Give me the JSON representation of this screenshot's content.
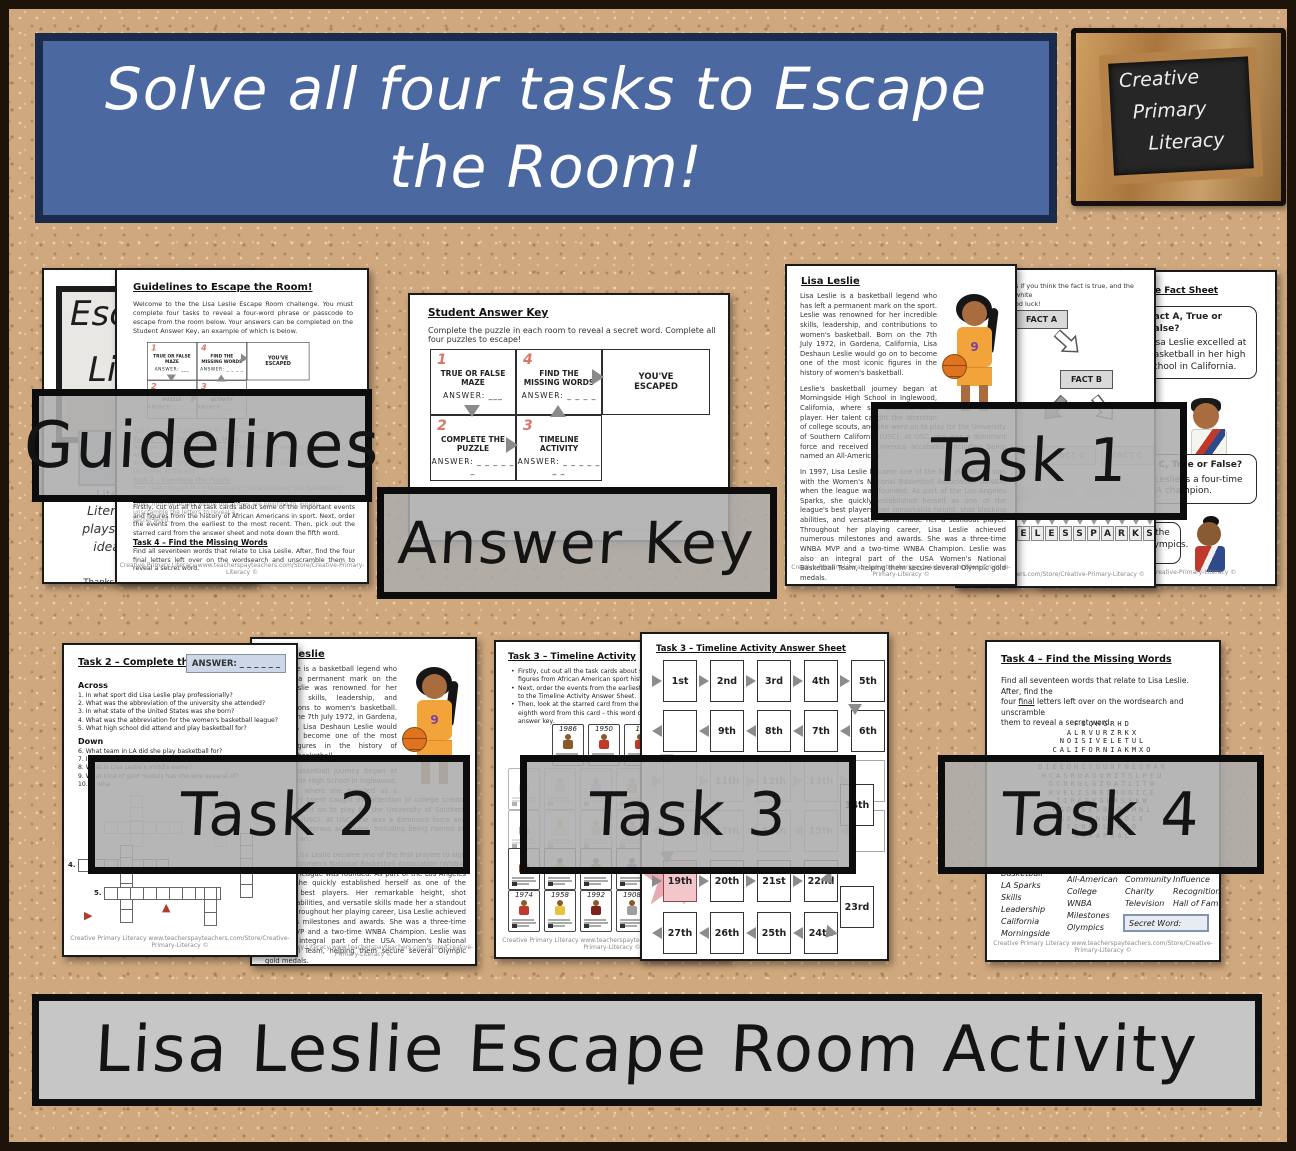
{
  "colors": {
    "cork": "#d0a87e",
    "banner_blue": "#4b69a0",
    "banner_border": "#1b2b4c",
    "label_gray": "#acacac",
    "red_number": "#d9776b",
    "star_pink": "#e9aab1",
    "jersey_orange": "#f2a33a",
    "link_blue": "#3344cc"
  },
  "banner": {
    "line1": "Solve all four tasks to Escape",
    "line2": "the Room!"
  },
  "logo": {
    "line1": "Creative",
    "line2": "Primary",
    "line3": "Literacy"
  },
  "bottom_banner": {
    "text": "Lisa Leslie Escape Room Activity"
  },
  "labels": {
    "guidelines": "Guidelines",
    "answer_key": "Answer Key",
    "task1": "Task 1",
    "task2": "Task 2",
    "task3": "Task 3",
    "task4": "Task 4"
  },
  "footer_text": "Creative Primary Literacy www.teacherspayteachers.com/Store/Creative-Primary-Literacy  ©",
  "cover": {
    "big1": "Esc",
    "big2": "Lis",
    "link1": "Literacy s",
    "hand_lines": [
      "Literacy re",
      "playscripts,",
      "ideas and",
      "ac"
    ],
    "thanks_pre": "Thanks to ",
    "thanks_link": "Prince"
  },
  "guidelines_page": {
    "title": "Guidelines to Escape the Room!",
    "intro": "Welcome to the the Lisa Leslie Escape Room challenge. You must complete four tasks to reveal a four-word phrase or passcode to escape from the room below. Your answers can be completed on the Student Answer Key, an example of which is below.",
    "faded_lines": [
      {
        "t": "Just follow the instructions for each task and",
        "c": ""
      },
      {
        "t": "Task 1 – The True or False Maze",
        "c": "fh"
      },
      {
        "t": "Work your way through the maze from the start, reading each fact and working out if it is true",
        "c": ""
      },
      {
        "t": "or false. Then follow the arrows to the next fact until you reach one of the boxes at the end",
        "c": ""
      },
      {
        "t": "Task 2 – Complete the Puzzle",
        "c": "fh"
      },
      {
        "t": "First, read through the informational text and answer the questions to complete the crossword.",
        "c": ""
      },
      {
        "t": "Then, find the letters where the arrows are pointing to. Finally, unscramble the letters to reveal a",
        "c": ""
      },
      {
        "t": "secret word.",
        "c": ""
      }
    ],
    "task3_heading": "Task 3 – Timeline Activity",
    "task3_text": "Firstly, cut out all the task cards about some of the important events and figures from the history of African Americans in sport. Next, order the events from the earliest to the most recent. Then, pick out the starred card from the answer sheet and note down the fifth word.",
    "task4_heading": "Task 4 – Find the Missing Words",
    "task4_text": "Find all seventeen words that relate to Lisa Leslie. After, find the four final letters left over on the wordsearch and unscramble them to reveal a secret word."
  },
  "answer_key": {
    "title": "Student Answer Key",
    "intro": "Complete the puzzle in each room to reveal a secret word. Complete all four puzzles to escape!",
    "c1": {
      "num": "1",
      "name": "TRUE OR FALSE MAZE",
      "answer": "ANSWER: ___"
    },
    "c4": {
      "num": "4",
      "name": "FIND THE MISSING WORDS",
      "answer": "ANSWER: _ _ _ _"
    },
    "escaped": "YOU'VE ESCAPED",
    "c2": {
      "num": "2",
      "name": "COMPLETE THE PUZZLE",
      "answer": "ANSWER: _ _ _ _ _ _"
    },
    "c3": {
      "num": "3",
      "name": "TIMELINE ACTIVITY",
      "answer": "ANSWER: _ _ _ _ _ _ _"
    }
  },
  "passage": {
    "title": "Lisa Leslie",
    "jersey_number": "9",
    "paragraphs": [
      "Lisa Leslie is a basketball legend who has left a permanent mark on the sport. Leslie was renowned for her incredible skills, leadership, and contributions to women's basketball. Born on the 7th July 1972, in Gardena, California, Lisa Deshaun Leslie would go on to become one of the most iconic figures in the history of women's basketball.",
      "Leslie's basketball journey began at Morningside High School in Inglewood, California, where she excelled as a player. Her talent caught the attention of college scouts, and she went on to play for the University of Southern California (USC). At USC, she was a dominant force and received numerous accolades, including being named an All-American.",
      "In 1997, Lisa Leslie became one of the first players to sign with the Women's National Basketball Association (WNBA) when the league was founded. As part of the Los Angeles Sparks, she quickly established herself as one of the league's best players. Her remarkable height, shot blocking abilities, and versatile skills made her a standout player. Throughout her playing career, Lisa Leslie achieved numerous milestones and awards. She was a three-time WNBA MVP and a two-time WNBA Champion. Leslie was also an integral part of the USA Women's National Basketball Team, helping them secure several Olympic gold medals.",
      "Lisa Leslie's impact on women's basketball extended beyond the court. She was a role model for aspiring young athletes and actively worked to promote the growth of women's basketball. She was involved in various community and charitable activities, using her platform to inspire others. Off the court, Lisa Leslie has worked in the media and entertainment industry. Her career included television appearances, book authorship, and involvement in charitable organizations.",
      "Her dedication to promoting women's sports and her positive influence on and off the court made her a beloved figure in the world of sports. In recognition of her extraordinary contributions to basketball, Lisa Leslie was inducted into the Naismith Memorial Basketball Hall of Fame, cementing her legacy as one of the most significant figures in the history of women's sports."
    ]
  },
  "maze": {
    "intro_line1": "s if you think the fact is true, and the white",
    "intro_line2": "od luck!",
    "fact_a": "FACT A",
    "fact_b": "FACT B",
    "fact_c": "FACT C",
    "letters": [
      "",
      "",
      "",
      "E",
      "L",
      "E",
      "S",
      "S",
      "P",
      "A",
      "R",
      "K",
      "S"
    ],
    "footer_fragment": "rspayteachers.com/Store/Creative-Primary-Literacy  ©"
  },
  "fact_sheet": {
    "heading": "e Fact Sheet",
    "bubble1_title": "Fact A, True or False?",
    "bubble1_lines": [
      "Lisa Leslie excelled at",
      "basketball in her high",
      "school in California."
    ],
    "bubble2_title": "Fact C, True or False?",
    "bubble2_lines": [
      "Lisa Leslie is a four-time",
      "WNBA champion."
    ],
    "bubble3_lines": [
      "in the",
      "Olympics."
    ],
    "footer_fragment": "achers.com/Store/Creative-Primary-Literacy  ©"
  },
  "task2": {
    "title": "Task 2 – Complete the Puzzle",
    "answer_box": "ANSWER: _ _ _ _ _ _",
    "across_heading": "Across",
    "across": [
      "1.  In what sport did Lisa Leslie play professionally?",
      "2.  What was the abbreviation of the university she attended?",
      "3.  In what state of the United States was she born?",
      "4.  What was the abbreviation for the women's basketball league?",
      "5.  What high school did attend and play basketball for?"
    ],
    "down_heading": "Down",
    "down": [
      "6.  What team in LA did she play basketball for?",
      "7.  In what city did she play professional basketball?",
      "8.  What is Lisa Leslie's middle name?",
      "9.  What kind of gold medals has she won several of?",
      "10. In wha"
    ],
    "num4": "4.",
    "num5": "5."
  },
  "task3": {
    "title": "Task 3 – Timeline Activity",
    "bullet_lines": [
      {
        "t": "Firstly, cut out all the task cards about some of the",
        "c": "bl"
      },
      {
        "t": "figures from African American sport history.",
        "c": ""
      },
      {
        "t": "Next, order the events from the earliest to the mo",
        "c": "bl"
      },
      {
        "t": "to the Timeline Activity Answer Sheet.",
        "c": ""
      },
      {
        "t": "Then, look at the starred card from the answer sh",
        "c": "bl"
      },
      {
        "t": "eighth word from this card – this word can now be",
        "c": ""
      },
      {
        "t": "answer key.",
        "c": ""
      }
    ],
    "cards_row1": [
      {
        "y": "1986",
        "f": "f-brown"
      },
      {
        "y": "1950",
        "f": "f-red"
      },
      {
        "y": "19",
        "f": "f-red"
      },
      {
        "y": "",
        "f": "f-blue"
      }
    ],
    "cards_row2": [
      {
        "y": "",
        "f": "f-green"
      },
      {
        "y": "",
        "f": "f-gray"
      },
      {
        "y": "",
        "f": "f-blue"
      },
      {
        "y": "",
        "f": "f-brown"
      }
    ],
    "cards_row3": [
      {
        "y": "",
        "f": "f-maroon"
      },
      {
        "y": "",
        "f": "f-yellow"
      },
      {
        "y": "",
        "f": "f-green"
      },
      {
        "y": "",
        "f": "f-red"
      }
    ],
    "cards_row4": [
      {
        "y": "",
        "f": "f-brown"
      },
      {
        "y": "",
        "f": "f-yellow"
      },
      {
        "y": "",
        "f": "f-green"
      },
      {
        "y": "",
        "f": "f-blue"
      }
    ],
    "cards_row5": [
      {
        "y": "1974",
        "f": "f-red"
      },
      {
        "y": "1958",
        "f": "f-yellow"
      },
      {
        "y": "1992",
        "f": "f-maroon"
      },
      {
        "y": "1908",
        "f": "f-gray"
      }
    ],
    "answer_sheet_title": "Task 3 – Timeline Activity Answer Sheet",
    "row1": [
      {
        "t": "1st",
        "c": ""
      },
      {
        "t": "2nd",
        "c": ""
      },
      {
        "t": "3rd",
        "c": ""
      },
      {
        "t": "4th",
        "c": ""
      },
      {
        "t": "5th",
        "c": ""
      }
    ],
    "row2": [
      {
        "t": "",
        "c": ""
      },
      {
        "t": "9th",
        "c": ""
      },
      {
        "t": "8th",
        "c": ""
      },
      {
        "t": "7th",
        "c": ""
      },
      {
        "t": "6th",
        "c": ""
      }
    ],
    "row3": [
      {
        "t": "",
        "c": ""
      },
      {
        "t": "11th",
        "c": ""
      },
      {
        "t": "12th",
        "c": ""
      },
      {
        "t": "13th",
        "c": ""
      },
      {
        "t": "",
        "c": ""
      }
    ],
    "row4": [
      {
        "t": "",
        "c": ""
      },
      {
        "t": "17th",
        "c": ""
      },
      {
        "t": "16th",
        "c": ""
      },
      {
        "t": "15th",
        "c": ""
      },
      {
        "t": "",
        "c": ""
      }
    ],
    "row5": [
      {
        "t": "19th",
        "c": "pinkbox"
      },
      {
        "t": "20th",
        "c": ""
      },
      {
        "t": "21st",
        "c": ""
      },
      {
        "t": "22nd",
        "c": ""
      }
    ],
    "row6": [
      {
        "t": "27th",
        "c": ""
      },
      {
        "t": "26th",
        "c": ""
      },
      {
        "t": "25th",
        "c": ""
      },
      {
        "t": "24th",
        "c": ""
      }
    ],
    "offset14": "14th",
    "offset23": "23rd"
  },
  "task4": {
    "title": "Task 4 – Find the Missing Words",
    "intro_l1": "Find all seventeen words that relate to Lisa Leslie. After, find the",
    "intro_l2a": "four ",
    "intro_l2b": "final",
    "intro_l2c": " letters left over on the wordsearch and unscramble",
    "intro_l3": "them to reveal a secret word.",
    "grid_rows": [
      "FSQHGRHD",
      "ALRVURZRKX",
      "NOISIVELETUL",
      "CALIFORNIAKMXO",
      "MOMRFMNBQNPAIVLL",
      "DIEEOHCYGUNFNEOMAR",
      "HCASRUAOUMZTSLPEU",
      "DCNKGLGZOATLITW",
      "RVELISNROMOGICE",
      "IIRAEKGERSSKW",
      "PGDYBEVBODSMNL",
      "GEYTINUMMOCE",
      "ECNEULFNIO",
      "SKRAPSAL"
    ],
    "words_col1": [
      "Basketball",
      "LA Sparks",
      "Skills",
      "Leadership",
      "California",
      "Morningside"
    ],
    "words_col2": [
      "All-American",
      "College",
      "WNBA",
      "Milestones",
      "Olympics"
    ],
    "words_col3": [
      "Community",
      "Charity",
      "Television"
    ],
    "words_col4": [
      "Influence",
      "Recognition",
      "Hall of Fame"
    ],
    "secret_word_label": "Secret Word:"
  }
}
